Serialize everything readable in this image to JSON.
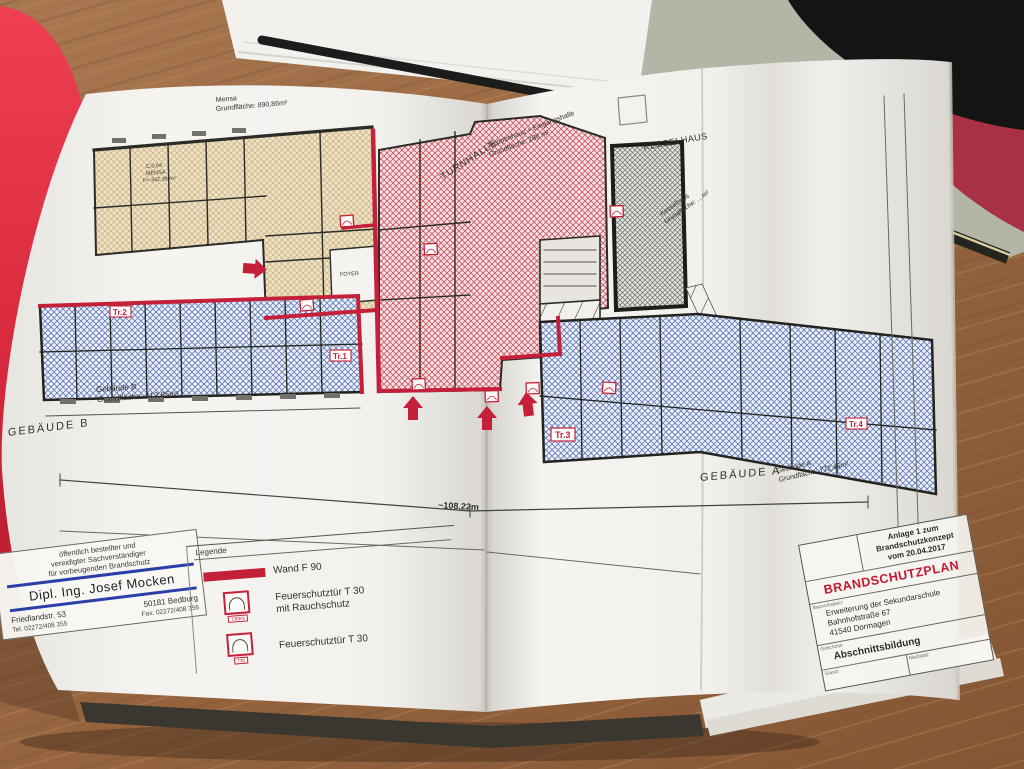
{
  "plan": {
    "labels": {
      "mensa_name": "Mensa",
      "mensa_area": "Grundfläche: 890,86m²",
      "turnhalle": "TURNHALLE",
      "treppenhaus_line1": "Treppenhaus + Eingangshalle",
      "treppenhaus_line2": "Grundfläche: 288 m²",
      "kesselhaus_heading": "KESSELHAUS",
      "kesselhaus_name": "Kesselhaus",
      "kesselhaus_area": "Grundfläche: …m²",
      "gebaeude_b_heading": "GEBÄUDE B",
      "gebaeude_b_name": "Gebäude B",
      "gebaeude_b_area": "Grundfläche: 413,85m²",
      "gebaeude_a_heading": "GEBÄUDE A",
      "gebaeude_a_name": "Gebäude A",
      "gebaeude_a_area": "Grundfläche: 772,46m²",
      "dimension_total": "~108,22m"
    },
    "rooms": {
      "c004_line1": "C.0.04",
      "c004_line2": "MENSA",
      "c004_line3": "F= 342,39 m²",
      "foyer": "FOYER"
    },
    "stairs": {
      "tr1": "Tr.1",
      "tr2": "Tr.2",
      "tr3": "Tr.3",
      "tr4": "Tr.4"
    }
  },
  "legend": {
    "title": "Legende",
    "wall_f90": "Wand F 90",
    "door_t30rs_line1": "Feuerschutztür T 30",
    "door_t30rs_line2": "mit Rauchschutz",
    "door_t30": "Feuerschutztür T 30",
    "tag_t30rs": "T30RS",
    "tag_t30": "T30"
  },
  "stamp": {
    "header_line1": "öffentlich bestellter und",
    "header_line2": "vereidigter Sachverständiger",
    "header_line3": "für vorbeugenden Brandschutz",
    "name": "Dipl. Ing. Josef Mocken",
    "street": "Friedlandstr. 53",
    "city": "50181 Bedburg",
    "tel": "Tel. 02272/408 355",
    "fax": "Fax: 02272/408 356"
  },
  "title_block": {
    "annex_line1": "Anlage 1 zum",
    "annex_line2": "Brandschutzkonzept",
    "annex_line3": "vom 20.04.2017",
    "title": "BRANDSCHUTZPLAN",
    "project_label": "Bauvorhaben:",
    "project_line1": "Erweiterung der Sekundarschule",
    "project_line2": "Bahnhofstraße 67",
    "project_line3": "41540 Dormagen",
    "section_label": "Geschoss:",
    "section_value": "Abschnittsbildung",
    "stand_label": "Stand:",
    "scale_label": "Maßstab:"
  },
  "colors": {
    "accent_red": "#c5203a",
    "title_red": "#c0182e",
    "stamp_blue": "#2a3fa8",
    "zone_beige_hatch": "#c8ae7e",
    "zone_red_hatch": "#c84f60",
    "zone_blue_hatch": "#5c78b5",
    "desk_wood": "#96653f",
    "folder_red": "#d92a3e",
    "page_white": "#f4f3f0"
  }
}
